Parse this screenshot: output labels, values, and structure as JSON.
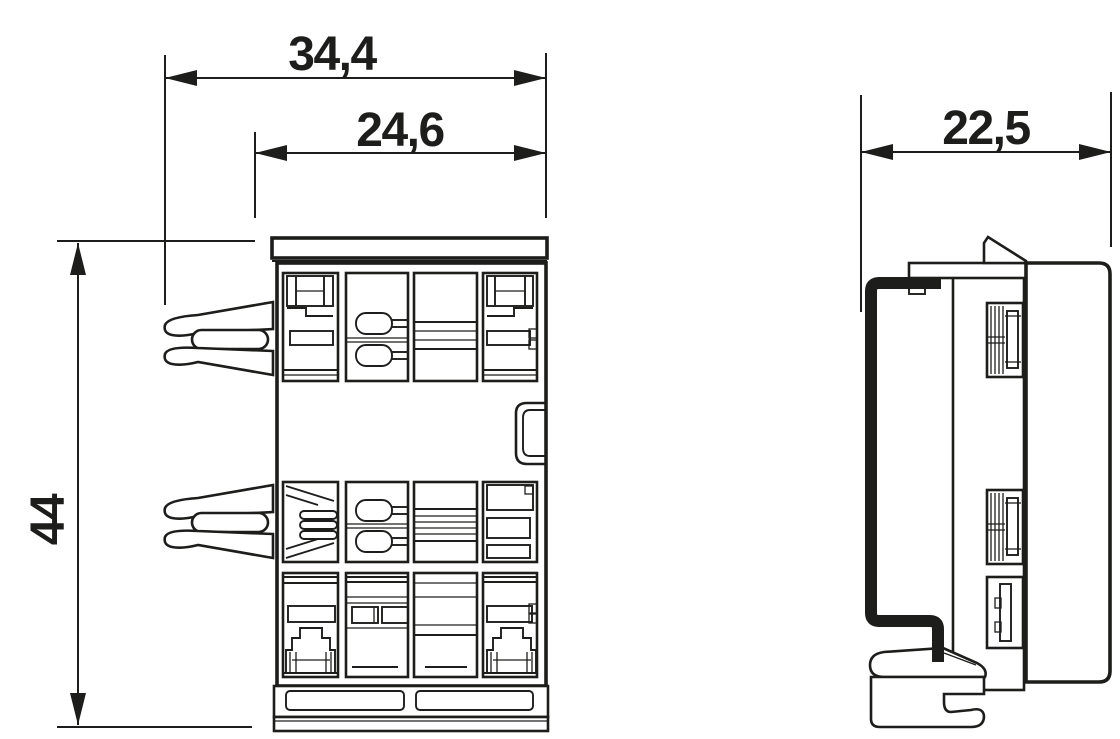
{
  "drawing": {
    "background": "#ffffff",
    "line_color": "#1d1d1b",
    "views": {
      "front": {
        "dimensions": {
          "overall_width": "34,4",
          "inner_width": "24,6",
          "height": "44"
        }
      },
      "side": {
        "dimensions": {
          "depth": "22,5"
        }
      }
    }
  }
}
